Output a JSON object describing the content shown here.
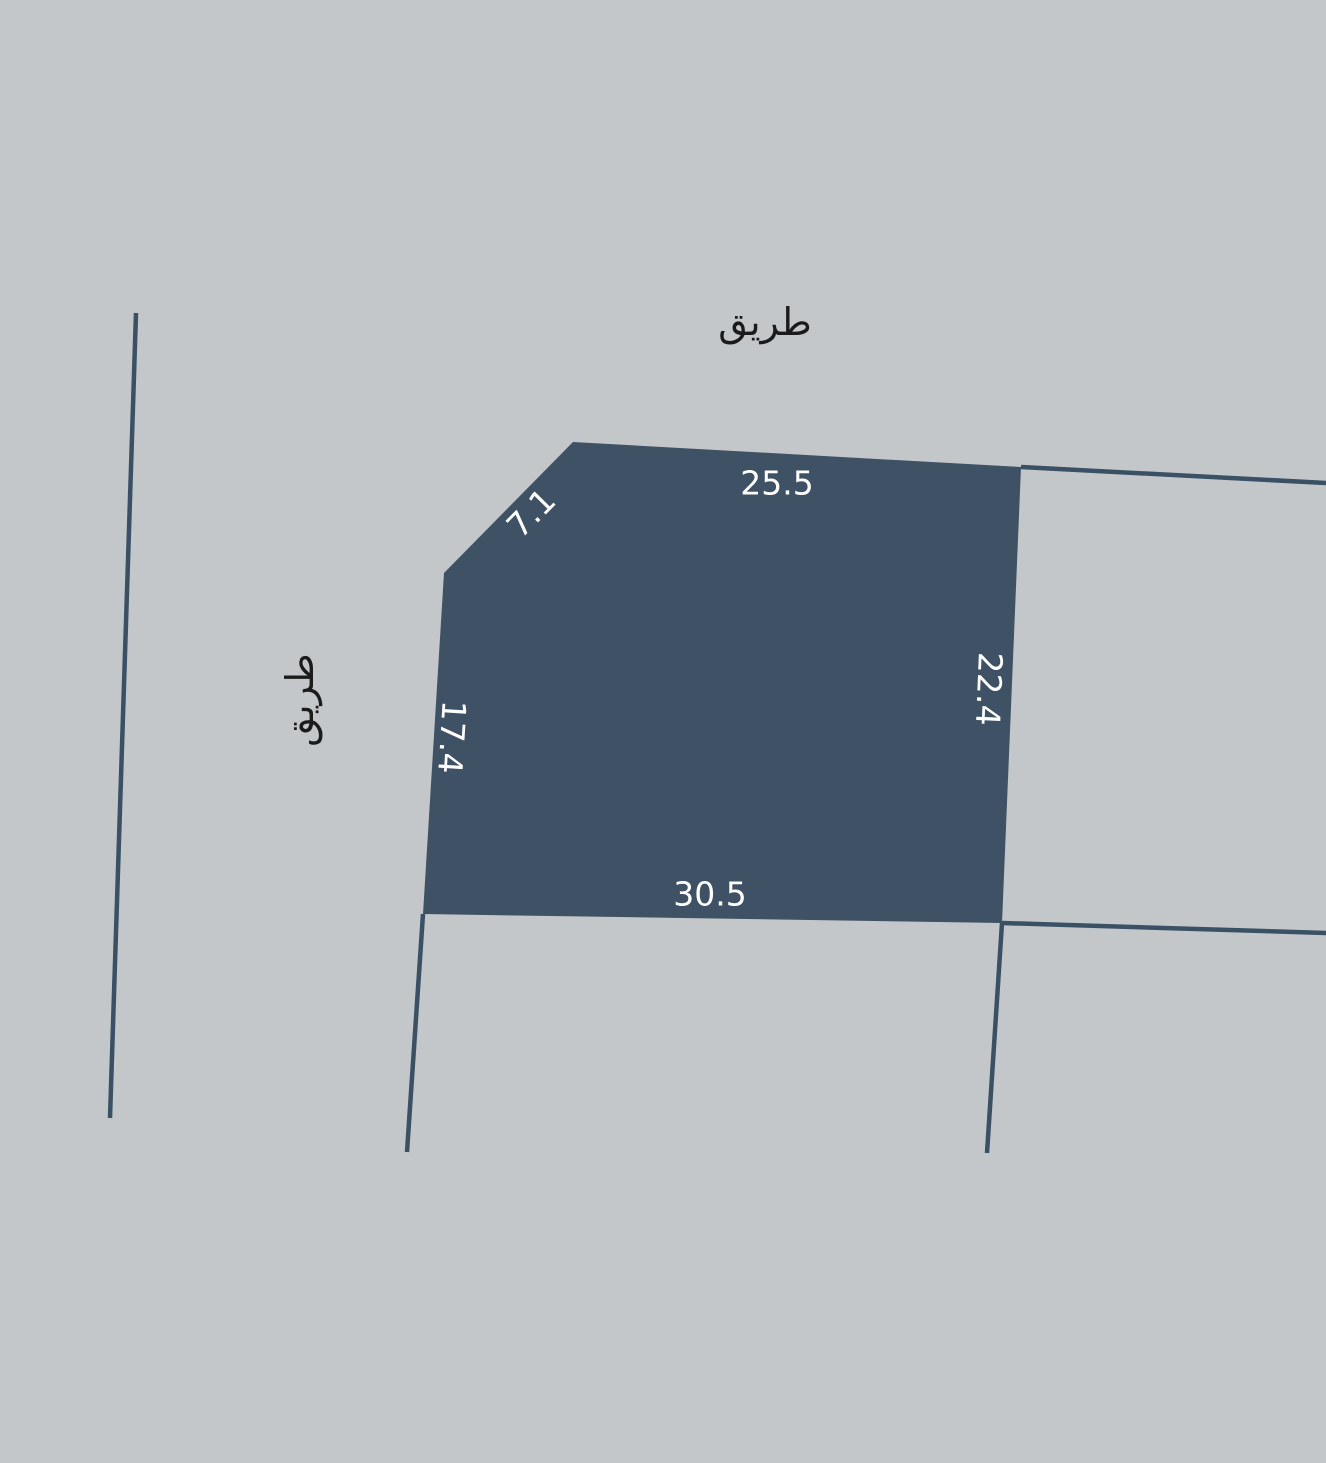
{
  "canvas": {
    "width": 1326,
    "height": 1463,
    "background_color": "#c3c7ca"
  },
  "parcel": {
    "fill_color": "#3f5164",
    "dimension_text_color": "#ffffff",
    "dimensions": {
      "top": "25.5",
      "chamfer_top_left": "7.1",
      "left": "17.4",
      "right": "22.4",
      "bottom": "30.5"
    }
  },
  "roads": {
    "label_color": "#1b1b1b",
    "top_label": "طريق",
    "left_label": "طريق"
  },
  "boundary_lines": {
    "color": "#3a5065"
  }
}
